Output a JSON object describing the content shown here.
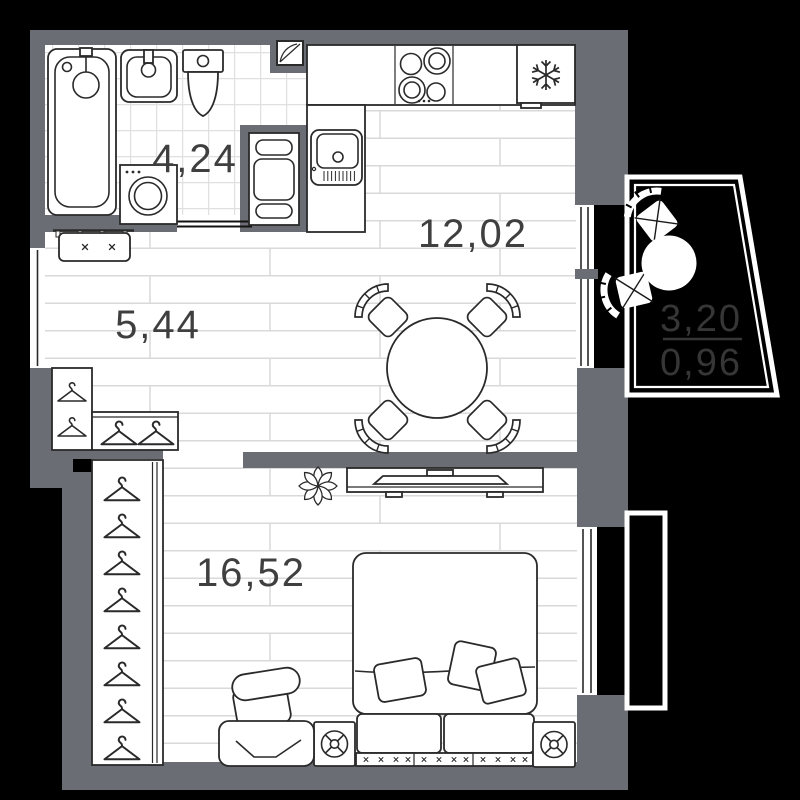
{
  "title": "apartment-floor-plan",
  "rooms": {
    "bathroom": {
      "area": "4,24"
    },
    "hallway": {
      "area": "5,44"
    },
    "kitchen_living": {
      "area": "12,02"
    },
    "bedroom": {
      "area": "16,52"
    }
  },
  "balcony": {
    "area_total": "3,20",
    "area_counted": "0,96"
  },
  "colors": {
    "background": "#000000",
    "wall": "#6a6e74",
    "outline": "#2a2a2a",
    "floor_line": "#d9d9d9",
    "tile_line": "#e0e0e0",
    "room_label": "#3f3f3f",
    "balcony_label": "#363636",
    "white": "#ffffff"
  },
  "icons": {
    "fridge": "snowflake-icon",
    "stove": "four-burner-icon",
    "bathroom_fan": "vent-icon",
    "wardrobes": "hanger-icon",
    "nightstands": "fan-knob-icon",
    "decor": "flower-icon"
  }
}
